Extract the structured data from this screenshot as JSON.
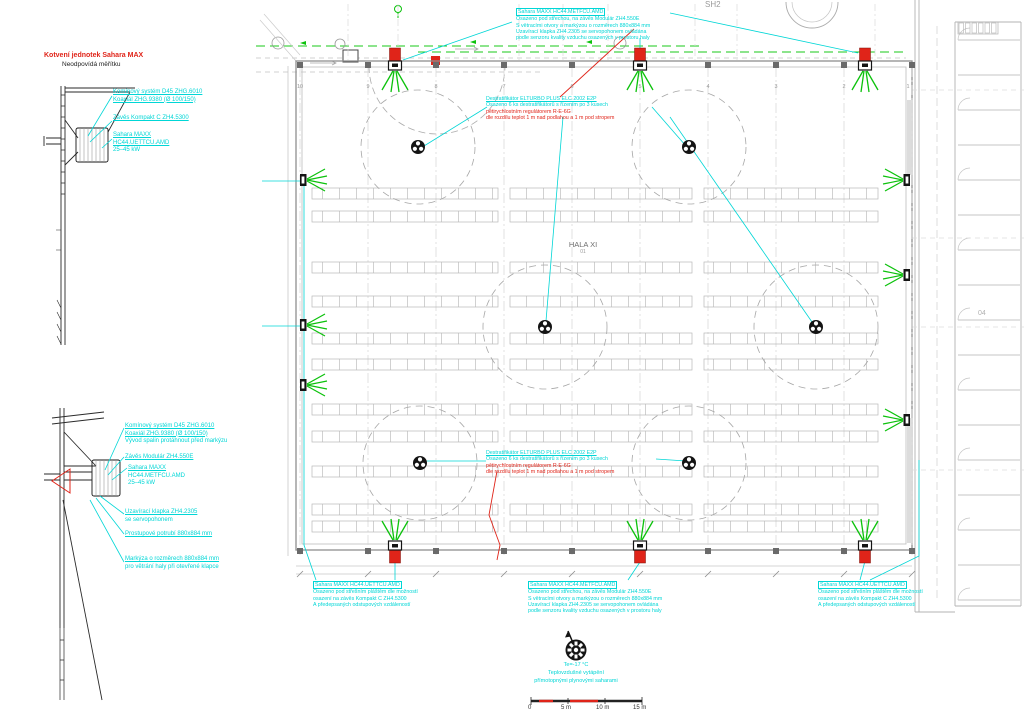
{
  "colors": {
    "annotation_cyan": "#00d6d6",
    "alert_red": "#e02419",
    "spray_green": "#0cc20c",
    "line_gray": "#9a9a9a"
  },
  "detail_top": {
    "title": "Kotvení jednotek Sahara MAX",
    "subtitle": "Neodpovídá měřítku",
    "label_chimney1": "Komínový systém D45 ZHG.6010",
    "label_chimney2": "Koaxiál ZHG.9380 (Ø 100/150)",
    "label_hanger": "Závěs Kompakt C ZH4.5300",
    "label_unit1": "Sahara MAXX",
    "label_unit2": "HC44.UETTCU.AMD",
    "label_unit3": "25–45 kW"
  },
  "detail_bottom": {
    "label_chimney1": "Komínový systém D45 ZHG.6010",
    "label_chimney2": "Koaxiál ZHG.9380 (Ø 100/150)",
    "label_chimney3": "Vývod spalin protáhnout před markýzu",
    "label_hanger": "Závěs Modulár ZH4.550E",
    "label_unit1": "Sahara MAXX",
    "label_unit2": "HC44.METFCU.AMD",
    "label_unit3": "25–45 kW",
    "label_damper1": "Uzavírací klapka ZH4.2305",
    "label_damper2": "se servopohonem",
    "label_duct": "Prostupové potrubí 880x884 mm",
    "label_awning1": "Markýza o rozměrech 880x884 mm",
    "label_awning2": "pro větrání haly při otevřené klapce"
  },
  "hall": {
    "name": "HALA XI",
    "number": "01",
    "sh2": "SH2",
    "room_04": "04",
    "grid_columns": [
      "10",
      "9",
      "8",
      "7",
      "6",
      "5",
      "4",
      "3",
      "2",
      "1"
    ]
  },
  "annotations": {
    "roof_units": {
      "l1": "Sahara MAXX   HC44.METFCU.AMD",
      "l2": "Osazeno pod střechou, na závěs Modulár ZH4.550E",
      "l3": "S větracími otvory a markýzou o rozměrech 880x884 mm",
      "l4": "Uzavírací klapka ZH4.2305 se servopohonem ovládána",
      "l5": "podle senzoru kvality vzduchu osazených v prostoru haly"
    },
    "destratifier": {
      "l1": "Destratifikátor ELTURBO PLUS ELC 2002 E2P",
      "l2": "Osazeno 6 ks destratifikátorů s řízením po 3 kusech",
      "l3": "pětirychlostním regulátorem R-E-6G",
      "l4": "dle rozdílu teplot 1 m nad podlahou a 1 m pod stropem"
    },
    "wall_units": {
      "l1": "Sahara MAXX   HC44.UETTCU.AMD",
      "l2": "Osazeno pod střešním pláštěm dle možností",
      "l3": "osazení na závěs Kompakt C ZH4.5300",
      "l4": "A předepsaných odstupových vzdáleností"
    }
  },
  "legend": {
    "temp": "Te=-17 °C",
    "heating_line1": "Teplovzdušné vytápění",
    "heating_line2": "přímotopnými plynovými saharami"
  },
  "scale_bar": {
    "labels": [
      "0",
      "5 m",
      "10 m",
      "15 m"
    ]
  }
}
